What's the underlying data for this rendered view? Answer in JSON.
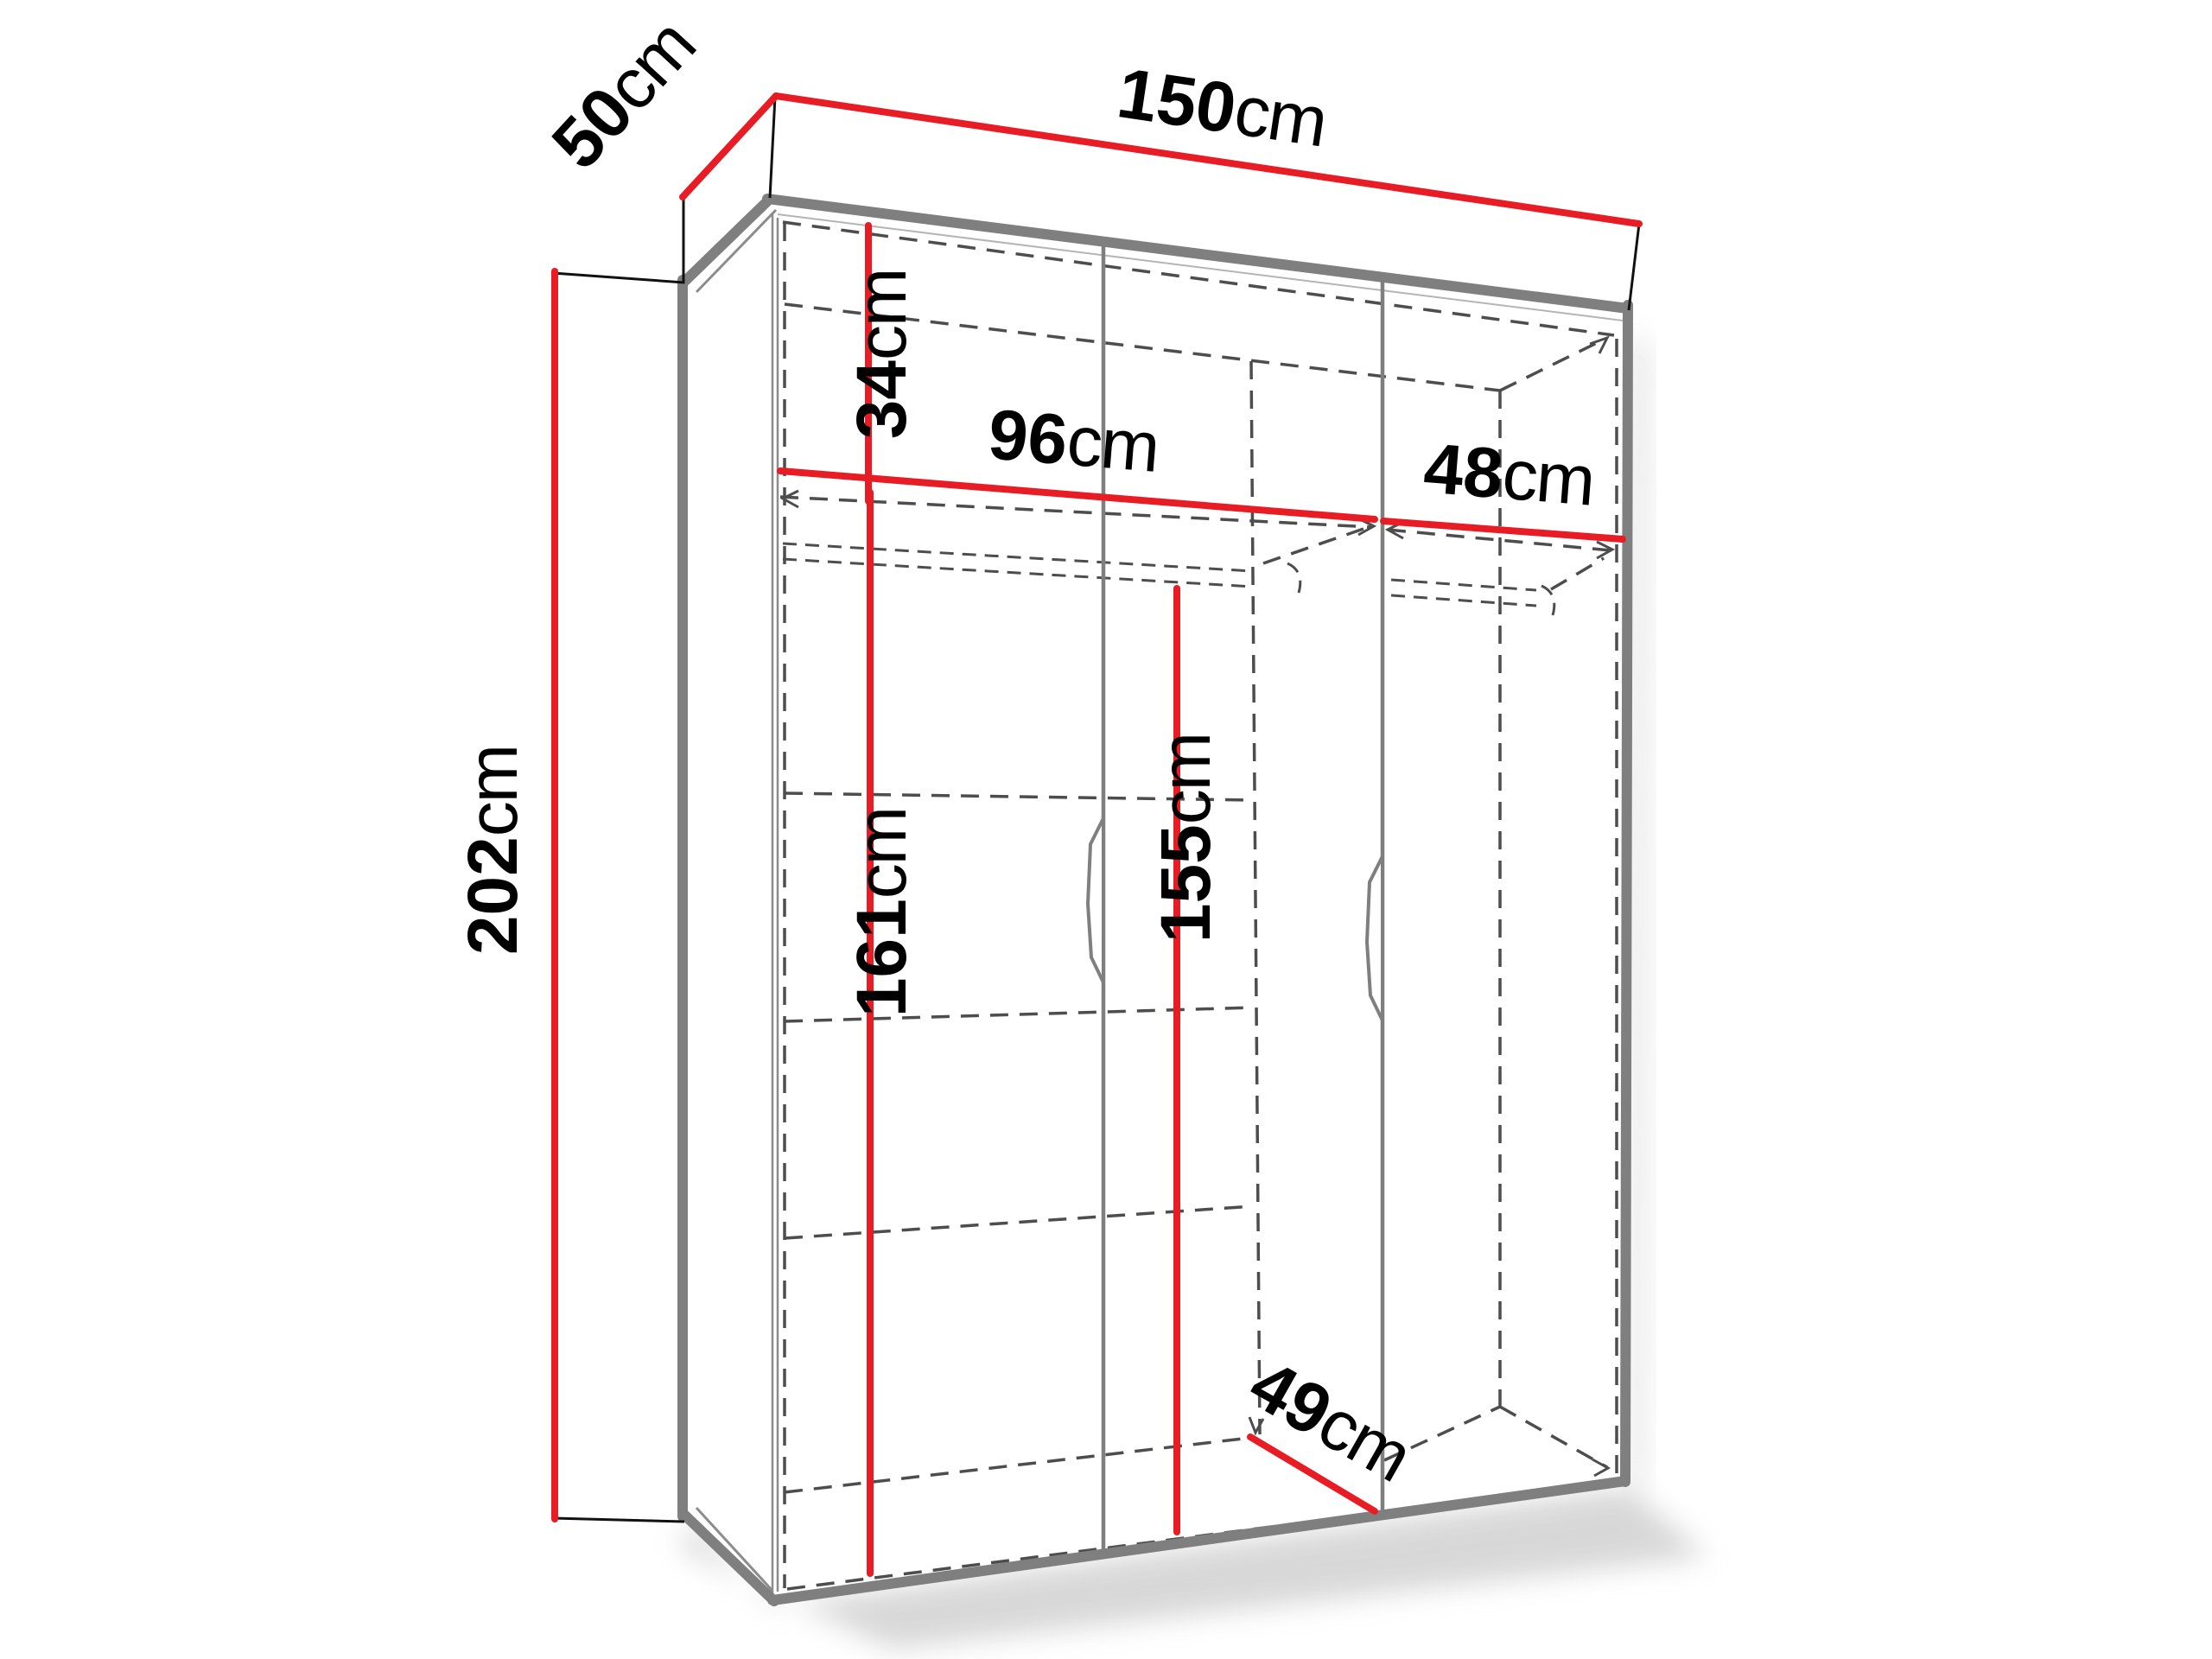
{
  "diagram": {
    "title": "wardrobe-dimension-drawing",
    "type": "furniture-dimension-diagram",
    "unit": "cm",
    "colors": {
      "dimension_line": "#e81c24",
      "cabinet_edge": "#7f7f7f",
      "hidden_line": "#4d4d4d",
      "extension_line": "#111111",
      "label_text": "#000000"
    },
    "dimensions": {
      "width": {
        "value": "150",
        "unit": "cm"
      },
      "depth": {
        "value": "50",
        "unit": "cm"
      },
      "height": {
        "value": "202",
        "unit": "cm"
      },
      "top_shelf_height": {
        "value": "34",
        "unit": "cm"
      },
      "left_section_width": {
        "value": "96",
        "unit": "cm"
      },
      "right_section_width": {
        "value": "48",
        "unit": "cm"
      },
      "left_interior_height": {
        "value": "161",
        "unit": "cm"
      },
      "hanging_height": {
        "value": "155",
        "unit": "cm"
      },
      "interior_depth": {
        "value": "49",
        "unit": "cm"
      }
    }
  }
}
